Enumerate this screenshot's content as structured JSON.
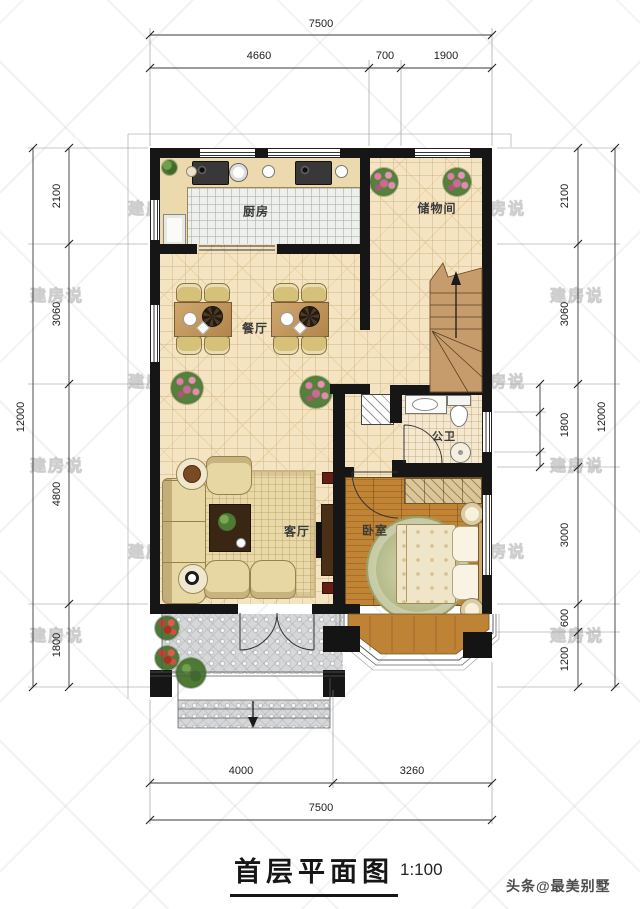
{
  "title": {
    "text": "首层平面图",
    "scale": "1:100"
  },
  "watermark": {
    "text": "建房说",
    "credit": "头条@最美别墅"
  },
  "rooms": {
    "kitchen": "厨房",
    "storage": "储物间",
    "dining": "餐厅",
    "bath": "公卫",
    "living": "客厅",
    "bedroom": "卧室"
  },
  "dims": {
    "top": {
      "total": "7500",
      "chain": [
        "4660",
        "700",
        "1900"
      ]
    },
    "bottom": {
      "total": "7500",
      "chain": [
        "4000",
        "3260"
      ]
    },
    "left": {
      "total": "12000",
      "chain": [
        "2100",
        "3060",
        "4800",
        "1800"
      ]
    },
    "right": {
      "total": "12000",
      "chain": [
        "2100",
        "3060",
        "1800",
        "3000",
        "600",
        "1200"
      ]
    }
  }
}
